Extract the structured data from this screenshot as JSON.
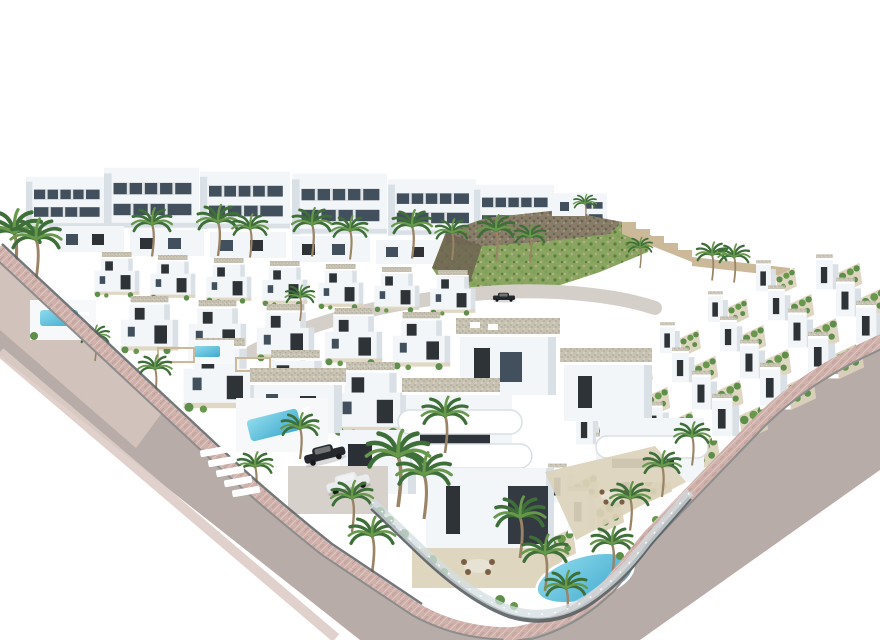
{
  "meta": {
    "title": "Aerial 3D architectural rendering of a white villa residential development",
    "description": "Bird's-eye computer rendering on a white background: rows of modern white villas with grey gravel flat roofs and dark window recesses, palm trees, turquoise swimming pools, a green scrub hillside with rocky ridge and stepped retaining walls, terraced townhouses with planted patios, and pink-paved streets with a pedestrian crosswalk and parked cars.",
    "width_px": 880,
    "height_px": 640
  },
  "palette": {
    "bg": "#ffffff",
    "wall_white": "#f3f6f8",
    "wall_shade": "#d9e0e6",
    "wall_dark": "#2e3338",
    "window_glass": "#41505c",
    "roof_gravel": "#c7c2b2",
    "roof_gravel_dark": "#a8a292",
    "road_asphalt": "#b7aca7",
    "road_embankment": "#d4c4be",
    "sidewalk_pink": "#cfb0aa",
    "sidewalk_light": "#ddccc6",
    "curb_grey": "#8e8e8e",
    "fence_dark": "#5a5f63",
    "glass_fence": "#d3dde1",
    "hill_green": "#8aa55f",
    "hill_green_dark": "#5d7d3f",
    "hill_rock": "#887d68",
    "hill_rock_dark": "#6e6352",
    "wall_tan": "#cbb99a",
    "palm_green": "#3e6f38",
    "palm_light": "#67984b",
    "shrub_green": "#5e8f4a",
    "pool_blue": "#3fa9cf",
    "pool_light": "#8fdbec",
    "terrace_beige": "#dcd2bb",
    "trunk_brown": "#9b8466",
    "car_dark": "#25282c",
    "car_white": "#e9ebed",
    "driveway_grey": "#d6d1ca"
  },
  "scene": {
    "background_color": "#ffffff",
    "regions": [
      {
        "name": "back-villa-row",
        "label": "Back row of two-storey white villas with glazing bands",
        "building_count": 7
      },
      {
        "name": "mid-villa-band",
        "label": "Middle band of low white houses",
        "building_count": 5
      },
      {
        "name": "hillside",
        "label": "Green scrub hillside with rocky ridge and stepped tan retaining walls"
      },
      {
        "name": "left-villa-field",
        "label": "Field of detached white villas with roof terraces and small pools",
        "building_count": 15
      },
      {
        "name": "main-road",
        "label": "Asphalt road with pink paver sidewalks entering from the left edge"
      },
      {
        "name": "crosswalk",
        "label": "Pedestrian crosswalk",
        "stripe_count": 5
      },
      {
        "name": "right-street",
        "label": "Street sweeping up to the right edge of the image"
      },
      {
        "name": "townhouse-rows",
        "label": "Diagonal rows of terraced townhouses with planted patios",
        "row_count": 4,
        "unit_count": 25
      },
      {
        "name": "foreground-villas",
        "label": "Large foreground villas with curved white balconies, gravel roofs, terraces and pools",
        "building_count": 3
      },
      {
        "name": "pools",
        "label": "Turquoise swimming pools",
        "count": 4
      },
      {
        "name": "cars",
        "label": "Parked cars",
        "count": 3,
        "colors": [
          "dark",
          "white",
          "dark"
        ]
      },
      {
        "name": "palm-trees",
        "label": "Palm trees",
        "approx_count": 34
      },
      {
        "name": "glass-fence",
        "label": "Curved glass balustrade on dark base wall around the corner plot"
      }
    ]
  }
}
